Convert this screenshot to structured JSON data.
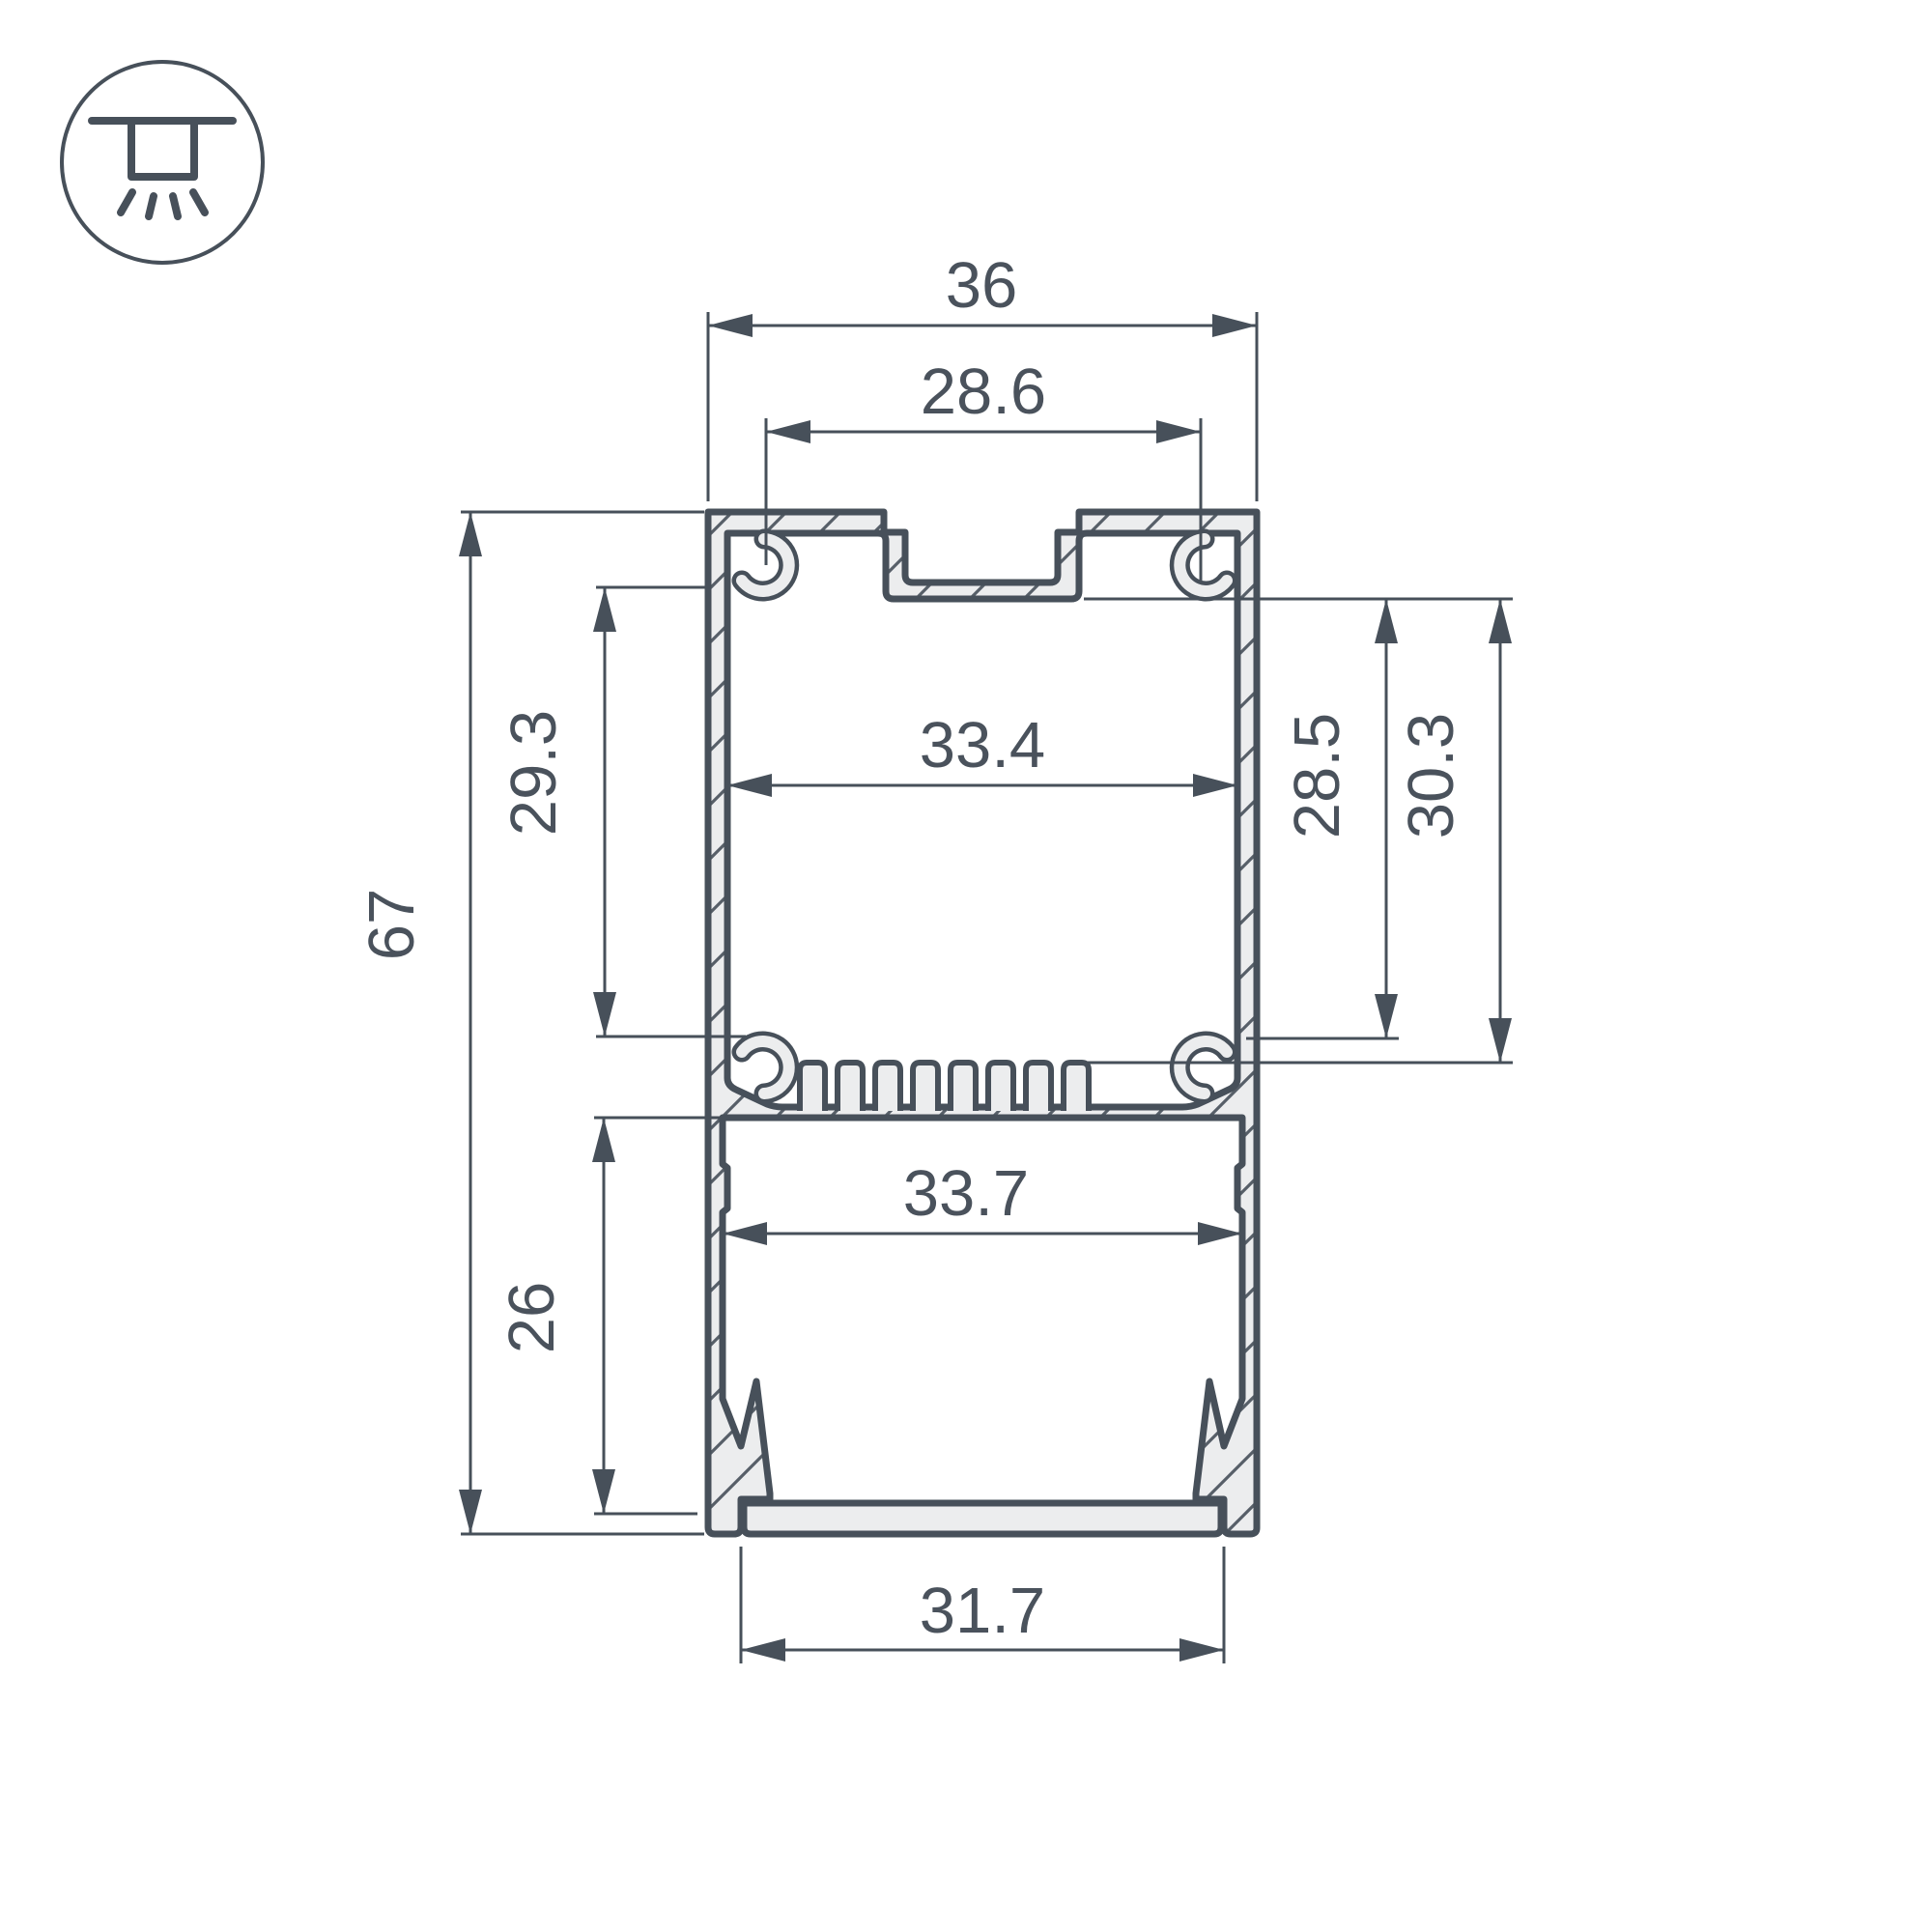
{
  "title": "LED profile cross-section dimension drawing",
  "icon": {
    "name": "recessed-ceiling-light-icon"
  },
  "dimensions": {
    "top_width": "36",
    "mount_slot_width": "28.6",
    "upper_inner_width": "33.4",
    "upper_inner_height": "29.3",
    "total_height": "67",
    "lower_inner_height": "26",
    "right_inner_height": "28.5",
    "right_outer_height": "30.3",
    "lower_inner_width": "33.7",
    "bottom_opening_width": "31.7"
  },
  "colors": {
    "line": "#47505a",
    "fill": "#ecedee",
    "text": "#4a525c",
    "background": "#ffffff"
  }
}
